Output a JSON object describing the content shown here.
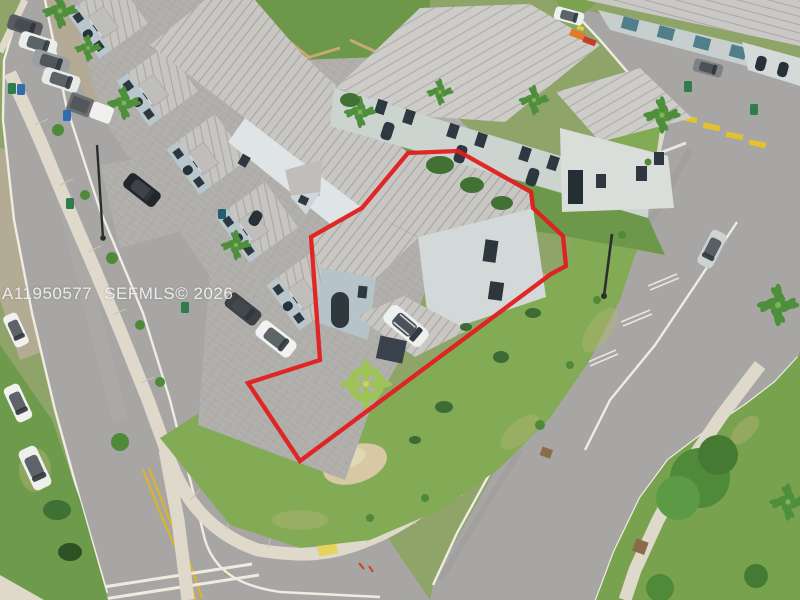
{
  "watermark": {
    "mls_id": "A11950577",
    "brand_year": "SEFMLS© 2026"
  },
  "photo": {
    "type": "aerial-drone-photo",
    "subject": "corner townhouse lot outlined in red",
    "outline_color": "#e21d1f"
  },
  "colors": {
    "road": "#a7a6a4",
    "sidewalk": "#ded9cb",
    "grass": "#83ab55",
    "roof": "#c8c7c3",
    "wall": "#b9c7cc",
    "red_outline": "#e21d1f",
    "yellow_marking": "#dcb42c"
  }
}
